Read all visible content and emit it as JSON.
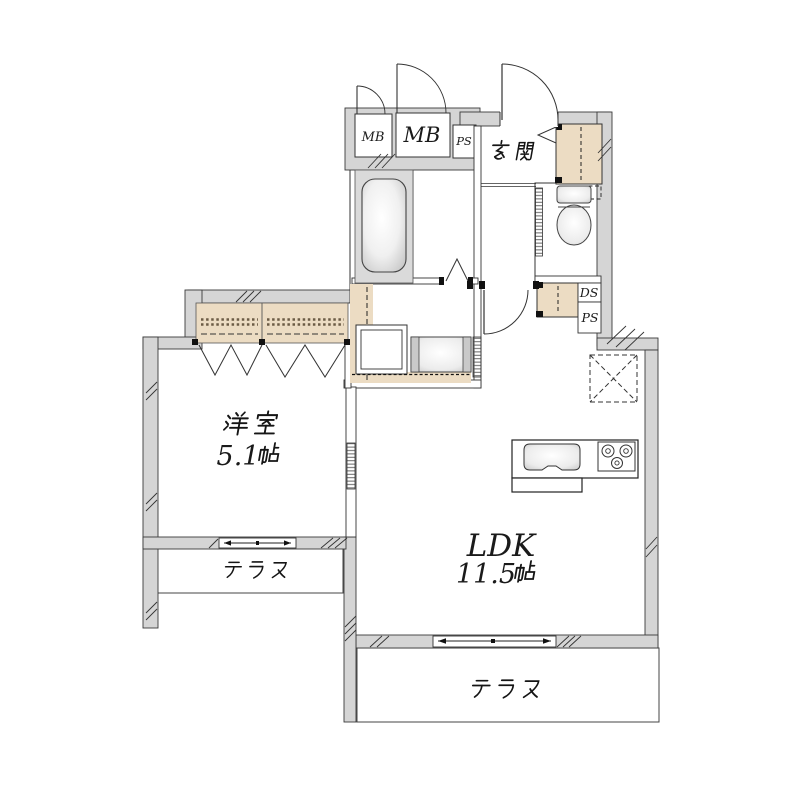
{
  "plan": {
    "entrance_label": "玄関",
    "western_room_label": "洋室",
    "western_room_size": "5.1帖",
    "western_room_size_number": "5.1",
    "ldk_label": "LDK",
    "ldk_size": "11.5帖",
    "ldk_size_number": "11.5",
    "size_unit": "帖",
    "terrace_west_label": "テラス",
    "terrace_south_label": "テラス",
    "meter_box_small": "MB",
    "meter_box_large": "MB",
    "pipe_space_top": "PS",
    "duct_space": "DS",
    "pipe_space_side": "PS"
  },
  "colors": {
    "wall_fill": "#d5d5d5",
    "line": "#2b2b2b",
    "cabinet_fill": "#ecdcc3",
    "fixture_shade": "#c9c9c9",
    "background": "#ffffff"
  }
}
